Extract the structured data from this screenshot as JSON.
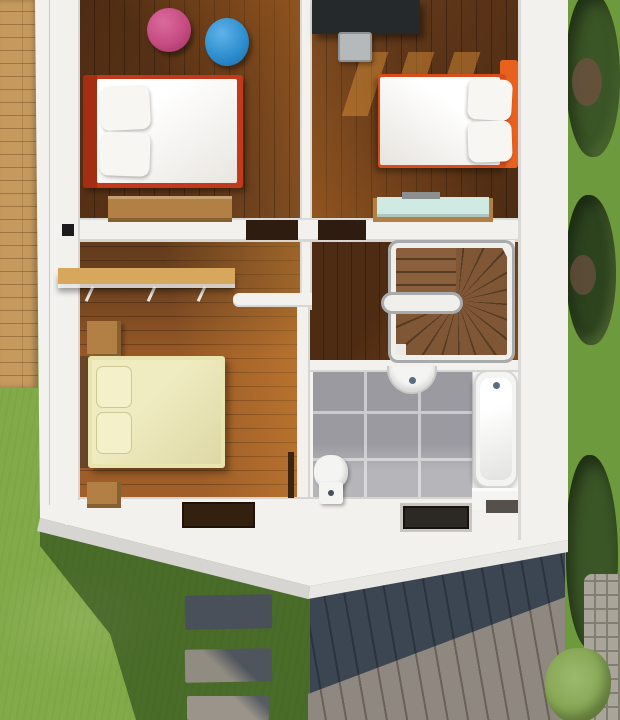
{
  "scene": {
    "name": "second-floor-plan-3d-render",
    "view": "top-down",
    "rooms": [
      {
        "id": "bedroom-top-left",
        "name": "bedroom with double bed and bean bags"
      },
      {
        "id": "bedroom-top-right",
        "name": "bedroom with desk and double bed"
      },
      {
        "id": "hallway",
        "name": "hallway with wall shelf"
      },
      {
        "id": "corridor",
        "name": "corridor to staircase"
      },
      {
        "id": "stairwell",
        "name": "winder staircase with railing"
      },
      {
        "id": "bedroom-bottom-left",
        "name": "bedroom with yellow double bed"
      },
      {
        "id": "bathroom",
        "name": "bathroom with tub, sink and toilet"
      }
    ],
    "furniture": [
      "bed-red-frame",
      "pillows",
      "pink-bean-bag",
      "blue-bean-bag",
      "wooden-dresser",
      "black-desk",
      "desk-chair",
      "bed-orange-frame",
      "teal-top-dresser",
      "wall-shelf",
      "yellow-bed",
      "nightstands",
      "toilet",
      "wall-sink",
      "bathtub",
      "bath-bench",
      "door-mat-brown",
      "door-mat-dark"
    ],
    "exterior": [
      "wood-deck",
      "deck-chair",
      "lawn",
      "house-shadow",
      "stepping-stones",
      "lower-roof-metal-panels",
      "hedge-right",
      "cobblestone-path",
      "bush-light-green"
    ]
  },
  "palette": {
    "grass_light": "#82aa48",
    "grass_mid": "#6d9a3c",
    "grass_shadow": "rgba(28,56,16,0.55)",
    "bush_dark": "#3a5526",
    "bush_darker": "#2c431e",
    "bush_light": "#9cba6e",
    "flower_brown": "#6e5040",
    "deck_wood": "#c69a5f",
    "deck_line": "rgba(110,72,30,0.45)",
    "wall_white": "#f2f1ee",
    "wall_shade": "#d9d7d3",
    "floor_dark": "#5c3418",
    "floor_dark2": "#4e2c13",
    "floor_lit": "rgba(220,130,40,0.40)",
    "floor_warm": "#9a5a26",
    "bed1_red": "#c23a1b",
    "bed1_red_dark": "#a32e12",
    "bed2_orange": "#d94d1c",
    "bed2_orange_bright": "#e8611f",
    "mattress": "#f4f2ee",
    "pillow": "#f8f6f2",
    "bed3_frame": "#e9e4ad",
    "bed3_mattress": "#f0ecc2",
    "bed3_head": "#6a4527",
    "beanbag_pink": "#c64b82",
    "beanbag_blue": "#2f8fd0",
    "desk_black": "#26292c",
    "chair_gray": "#b5b9bb",
    "chair_dark": "#3f4a3e",
    "dresser_wood": "#b28045",
    "dresser_teal": "#cfe9e3",
    "tile_gray": "#9a9aa0",
    "tile_grout": "#cbcbcf",
    "fixture": "#f4f4f2",
    "metal": "#5a6d80",
    "roof_dark": "#3b4652",
    "roof_rib": "rgba(10,16,24,0.35)",
    "roof_light": "#8f8880",
    "stone_dark": "#495059",
    "path": "#a9a59a",
    "path_joint": "#837e72",
    "mat_brown": "#33200f",
    "mat_dark": "#2c2824",
    "stair_tread": "#7f5636",
    "stair_gap": "#563a22",
    "rail": "#a8aaac",
    "shelf": "#d7a75e"
  }
}
